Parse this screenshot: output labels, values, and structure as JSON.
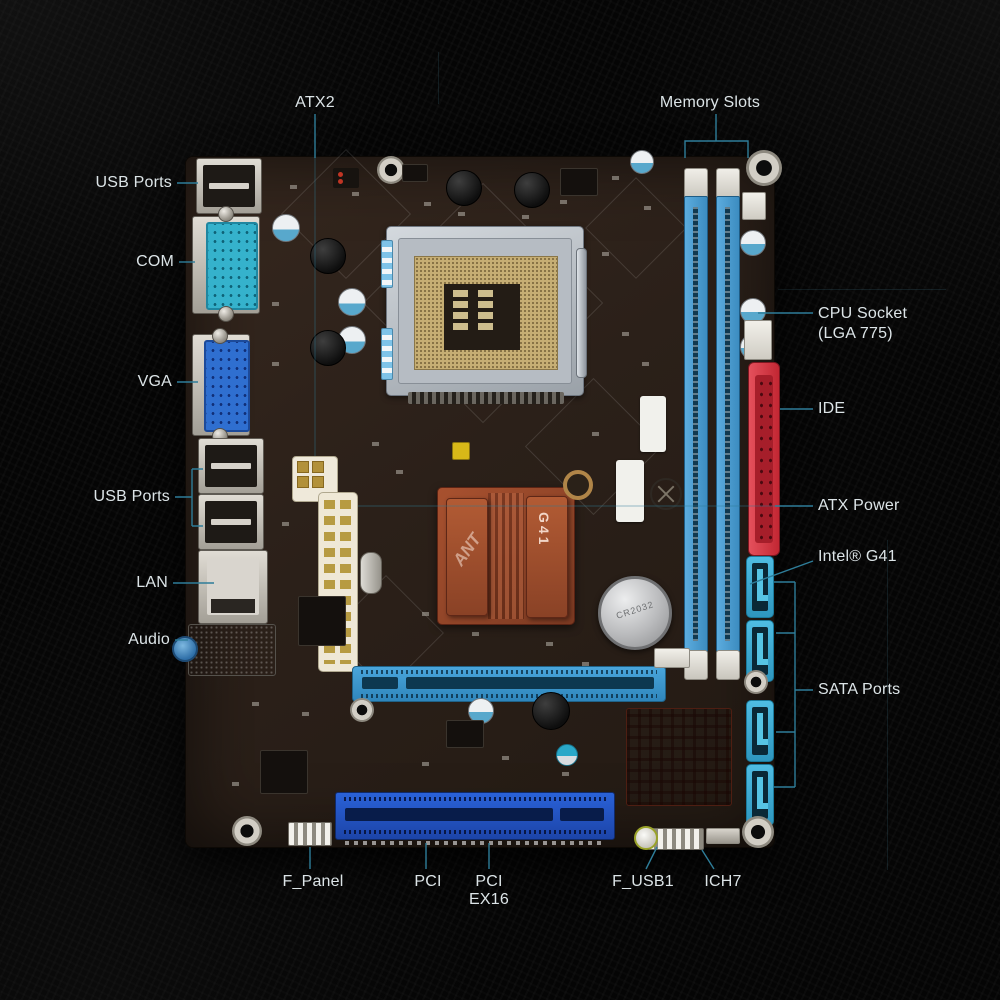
{
  "callouts": {
    "atx2": "ATX2",
    "memory_slots": "Memory Slots",
    "usb_ports_top": "USB Ports",
    "com": "COM",
    "vga": "VGA",
    "usb_ports_mid": "USB Ports",
    "lan": "LAN",
    "audio": "Audio",
    "cpu_socket_line1": "CPU Socket",
    "cpu_socket_line2": "(LGA 775)",
    "ide": "IDE",
    "atx_power": "ATX Power",
    "intel_g41": "Intel® G41",
    "sata_ports": "SATA Ports",
    "f_panel": "F_Panel",
    "pci": "PCI",
    "pci_ex16_line1": "PCI",
    "pci_ex16_line2": "EX16",
    "f_usb1": "F_USB1",
    "ich7": "ICH7"
  },
  "board_text": {
    "chipset_heatsink": "G41",
    "heatsink_logo": "ANT",
    "battery": "CR2032"
  },
  "colors": {
    "label_text": "#dce4e7",
    "leader_line": "#2e7d99",
    "pcb": "#2b2019",
    "memory_slot": "#4aa3d8",
    "ide_connector": "#d8323c",
    "pci_slot": "#2456c8",
    "pcie_slot": "#3d9bd4",
    "sata_port": "#3fb0d8",
    "chipset_heatsink": "#9a4a2c",
    "com_port": "#35b2cc",
    "vga_port": "#2f6fd0"
  }
}
